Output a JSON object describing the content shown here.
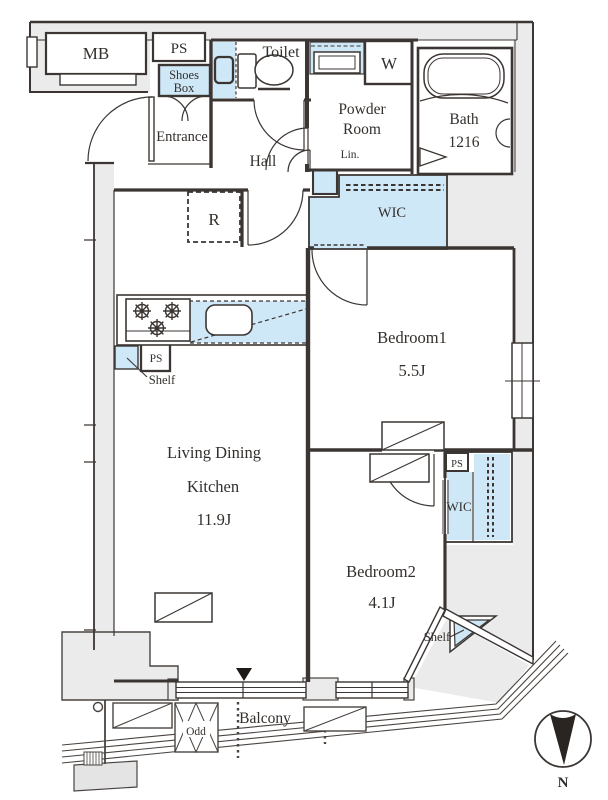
{
  "plan": {
    "rooms": {
      "toilet": {
        "label": "Toilet"
      },
      "entrance": {
        "label": "Entrance"
      },
      "hall": {
        "label": "Hall"
      },
      "powder_room": {
        "label_line1": "Powder",
        "label_line2": "Room"
      },
      "bath": {
        "label_line1": "Bath",
        "label_line2": "1216"
      },
      "ldk": {
        "label_line1": "Living Dining",
        "label_line2": "Kitchen",
        "size": "11.9J"
      },
      "bedroom1": {
        "label": "Bedroom1",
        "size": "5.5J"
      },
      "bedroom2": {
        "label": "Bedroom2",
        "size": "4.1J"
      },
      "balcony": {
        "label": "Balcony"
      }
    },
    "storage": {
      "shoes_box": {
        "label_line1": "Shoes",
        "label_line2": "Box"
      },
      "linen": {
        "label": "Lin."
      },
      "wic_bedroom1": {
        "label": "WIC"
      },
      "wic_bedroom2": {
        "label": "WIC"
      },
      "shelf_kitchen": {
        "label": "Shelf"
      },
      "shelf_bedroom2": {
        "label": "Shelf"
      }
    },
    "equipment": {
      "meter_box": {
        "label": "MB"
      },
      "pipe_space_top": {
        "label": "PS"
      },
      "pipe_space_kitchen": {
        "label": "PS"
      },
      "pipe_space_wic": {
        "label": "PS"
      },
      "refrigerator_space": {
        "label": "R"
      },
      "washer_space": {
        "label": "W"
      },
      "outdoor_unit": {
        "label": "Odd"
      }
    },
    "compass": {
      "label": "N"
    },
    "colors": {
      "closet_fill": "#cfe8f7",
      "exterior_fill": "#ebebeb",
      "line": "#3b3633"
    }
  }
}
